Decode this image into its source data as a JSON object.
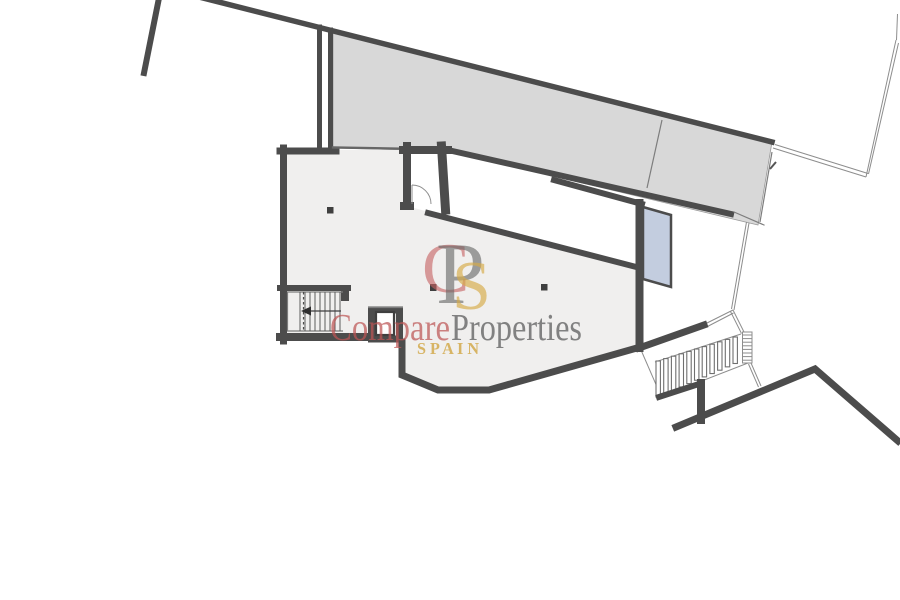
{
  "watermark": {
    "logo_letter_c": "C",
    "logo_letter_p": "P",
    "logo_letter_s": "S",
    "brand_compare": "Compare",
    "brand_properties": "Properties",
    "brand_country": "S P A I N",
    "color_compare": "rgba(188,84,84,0.72)",
    "color_properties": "rgba(92,92,92,0.75)",
    "color_country": "rgba(208,163,62,0.78)",
    "color_logo_c": "rgba(198,98,98,0.62)",
    "color_logo_p": "rgba(98,98,98,0.60)",
    "color_logo_s": "rgba(214,170,72,0.66)"
  },
  "palette": {
    "wall": "#4c4c4c",
    "terrace_fill": "#d8d8d8",
    "room_fill": "#f0efee",
    "glass_fill": "#c3cddf",
    "thin_line": "#7d7d7d",
    "column_fill": "#3f3f3f",
    "background": "#ffffff"
  },
  "plan": {
    "exterior_stairs": {
      "count": 11,
      "x0": 656,
      "y0": 361,
      "dx": 7.7,
      "dy": -2.4,
      "w": 4.4,
      "h0": 36,
      "dh": -0.95
    },
    "interior_stairs": {
      "count": 9,
      "x0": 300,
      "dx": 5,
      "y_top": 292,
      "y_bottom": 331
    },
    "fence_hatch": {
      "count": 8,
      "x": 742.5,
      "y0": 335,
      "dy": 3.6,
      "w": 9.5
    }
  }
}
